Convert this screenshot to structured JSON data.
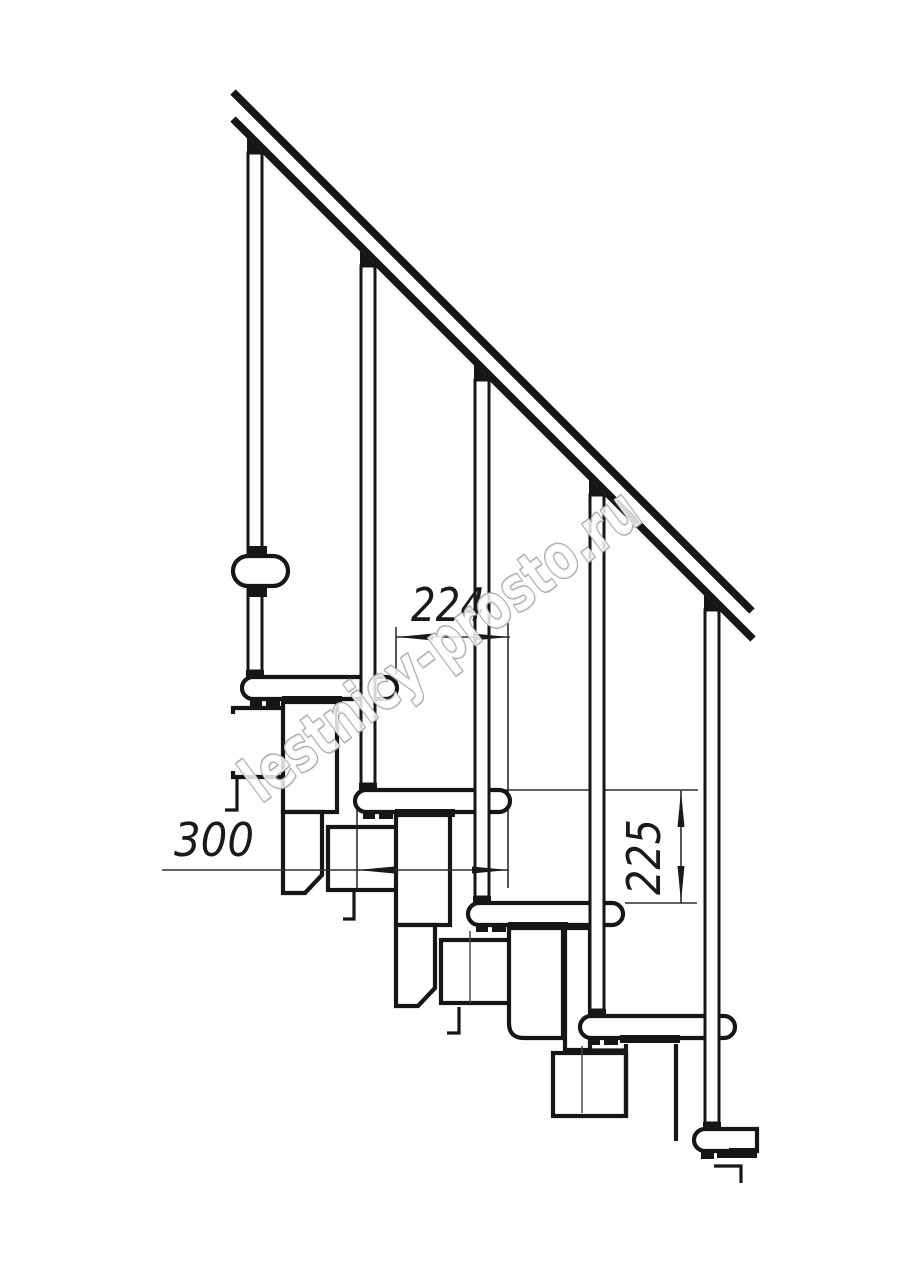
{
  "drawing": {
    "description": "Side-view technical drawing of a modular staircase with handrail",
    "dims": {
      "run": "224",
      "depth": "300",
      "rise": "225"
    },
    "watermark": {
      "text": "lestnicy-prosto.ru",
      "outline_color": "#a8a8a8",
      "fill_color": "#ffffff",
      "angle_deg": -36.5
    },
    "colors": {
      "background": "#ffffff",
      "line": "#161616",
      "dimension": "#2e2e2e"
    },
    "counts": {
      "handrails": 1,
      "balusters": 5,
      "treads": 5,
      "support_modules": 4
    }
  }
}
